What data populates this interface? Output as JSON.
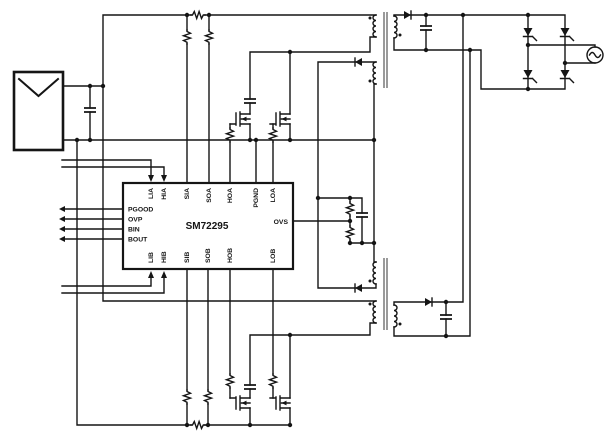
{
  "ic": {
    "part_number": "SM72295",
    "top_pins": [
      "LIA",
      "HIA",
      "SIA",
      "SOA",
      "HOA",
      "PGND",
      "LOA"
    ],
    "bottom_pins": [
      "LIB",
      "HIB",
      "SIB",
      "SOB",
      "HOB",
      "LOB"
    ],
    "left_pins": [
      "PGOOD",
      "OVP",
      "BIN",
      "BOUT"
    ],
    "right_pins": [
      "OVS"
    ]
  },
  "colors": {
    "wire": "#151515",
    "transformer_core": "#8f8f8f",
    "background": "#ffffff"
  }
}
